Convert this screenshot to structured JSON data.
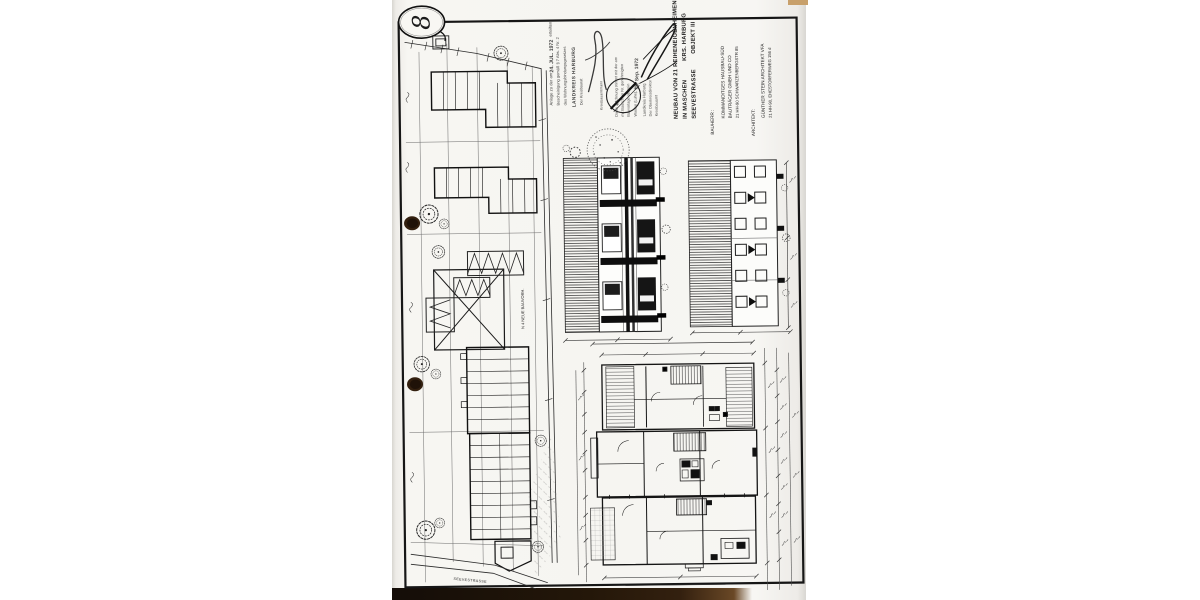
{
  "page": {
    "number": "8"
  },
  "title_block": {
    "project_line1": "NEUBAU VON 21 REIHENEIGENHEIMEN",
    "project_line2a": "IN MASCHEN",
    "project_line2b": "KRS. HARBURG",
    "project_line3a": "SEEVESTRASSE",
    "project_line3b": "OBJEKT III",
    "client_label": "BAUHERR :",
    "client_line1": "KOMMANDITGES HAUSBAU-SÜD",
    "client_line2": "BAUTRÄGER GMBH UND CO",
    "client_line3": "21 HH-90 SCHWARZENBERGSTR 85",
    "architect_label": "ARCHITEKT:",
    "architect_line1": "GÜNTHER STEIN ARCHITEKT VFA",
    "architect_line2": "21 HH-90, EHESTORFERWEG 156 d"
  },
  "approval_stamp": {
    "line1": "Anlage zu der am",
    "date": "24. JUL. 1972",
    "line1_end": "erteilten",
    "line2": "Bescheinigung gemäß § 7 Abs. 4 Nr. 2",
    "line3": "des Wohnungsbindungsgesetzes",
    "authority": "LANDKREIS HARBURG",
    "signer": "Der Kreisbaurat",
    "signer_title": "Kreisbauamtmann"
  },
  "review_stamp": {
    "line1": "Diese Zeichnung stimmt mit der am",
    "line2": "mit Bauschein Nr. genehmigten",
    "line3": "Bauvorlage überein",
    "line4": "Winsen (Luhe), den",
    "date": "18. Sep. 1972",
    "authority": "Landkreis Harburg",
    "office": "Der Oberkreisdirektor",
    "department": "Kreisbauamt"
  },
  "north_stamp": {
    "label": "N"
  },
  "site_plan": {
    "road_label": "SEEVESTRASSE",
    "note": "N 4 NEUE BAUVORH."
  },
  "colors": {
    "paper": "#f7f6f2",
    "ink": "#1a1a1a",
    "punch_hole": "#33200f",
    "scanner_strip": "#1d140c",
    "tape": "#c8a06b"
  }
}
